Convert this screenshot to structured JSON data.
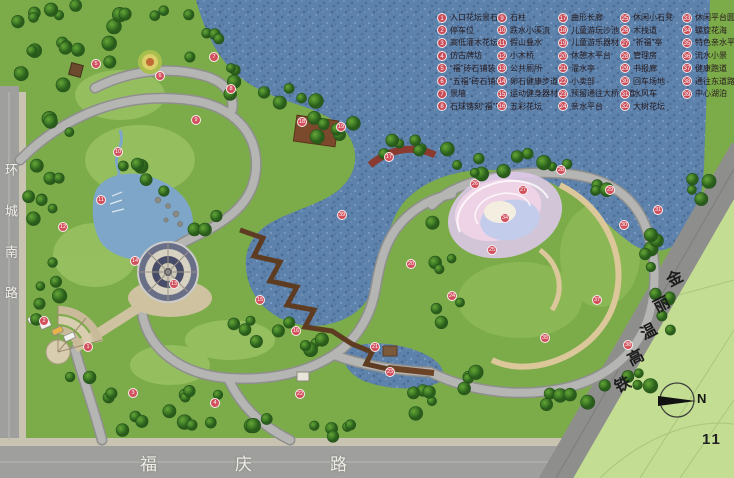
{
  "legend": {
    "columns": [
      {
        "items": [
          {
            "no": "1",
            "label": "入口花坛景石"
          },
          {
            "no": "2",
            "label": "停车位"
          },
          {
            "no": "3",
            "label": "高低灌木花坛"
          },
          {
            "no": "4",
            "label": "仿古牌坊"
          },
          {
            "no": "5",
            "label": "“福”砖石铺装"
          },
          {
            "no": "6",
            "label": "“五福”砖石铺装"
          },
          {
            "no": "7",
            "label": "景墙"
          },
          {
            "no": "8",
            "label": "石球镌刻“福”字"
          }
        ]
      },
      {
        "items": [
          {
            "no": "9",
            "label": "石柱"
          },
          {
            "no": "10",
            "label": "跌水小溪流"
          },
          {
            "no": "11",
            "label": "假山叠水"
          },
          {
            "no": "12",
            "label": "小木桥"
          },
          {
            "no": "13",
            "label": "公共厕所"
          },
          {
            "no": "14",
            "label": "卵石健康步道"
          },
          {
            "no": "15",
            "label": "运动健身器材"
          },
          {
            "no": "16",
            "label": "五彩花坛"
          }
        ]
      },
      {
        "items": [
          {
            "no": "17",
            "label": "曲形长廊"
          },
          {
            "no": "18",
            "label": "儿童游玩沙池"
          },
          {
            "no": "19",
            "label": "儿童游乐器材"
          },
          {
            "no": "20",
            "label": "休憩木平台"
          },
          {
            "no": "21",
            "label": "濯水亭"
          },
          {
            "no": "22",
            "label": "小卖部"
          },
          {
            "no": "23",
            "label": "预留通往大桥通道"
          },
          {
            "no": "24",
            "label": "亲水平台"
          }
        ]
      },
      {
        "items": [
          {
            "no": "25",
            "label": "休闲小石凳"
          },
          {
            "no": "26",
            "label": "木栈道"
          },
          {
            "no": "27",
            "label": "“祈福”亭"
          },
          {
            "no": "28",
            "label": "管理房"
          },
          {
            "no": "29",
            "label": "书报廊"
          },
          {
            "no": "30",
            "label": "回车场地"
          },
          {
            "no": "31",
            "label": "水风车"
          },
          {
            "no": "32",
            "label": "大树花坛"
          }
        ]
      },
      {
        "items": [
          {
            "no": "33",
            "label": "休闲平台圆凳"
          },
          {
            "no": "34",
            "label": "螺旋花海"
          },
          {
            "no": "35",
            "label": "特色亲水平台"
          },
          {
            "no": "36",
            "label": "流水小景"
          },
          {
            "no": "37",
            "label": "健康跑道"
          },
          {
            "no": "38",
            "label": "通往东道路"
          },
          {
            "no": "39",
            "label": "中心湖泊"
          }
        ]
      }
    ]
  },
  "roads": {
    "left_vertical": "环城南路",
    "bottom": "福庆路",
    "railway": "金丽温高铁"
  },
  "compass": {
    "label": "N"
  },
  "page_number": "11",
  "map_markers": [
    {
      "no": "5",
      "x": 96,
      "y": 64
    },
    {
      "no": "6",
      "x": 160,
      "y": 76
    },
    {
      "no": "7",
      "x": 214,
      "y": 57
    },
    {
      "no": "8",
      "x": 231,
      "y": 89
    },
    {
      "no": "9",
      "x": 196,
      "y": 120
    },
    {
      "no": "10",
      "x": 118,
      "y": 152
    },
    {
      "no": "11",
      "x": 101,
      "y": 200
    },
    {
      "no": "12",
      "x": 63,
      "y": 227
    },
    {
      "no": "14",
      "x": 135,
      "y": 261
    },
    {
      "no": "13",
      "x": 174,
      "y": 284
    },
    {
      "no": "2",
      "x": 44,
      "y": 321
    },
    {
      "no": "1",
      "x": 88,
      "y": 347
    },
    {
      "no": "3",
      "x": 133,
      "y": 393
    },
    {
      "no": "4",
      "x": 215,
      "y": 403
    },
    {
      "no": "15",
      "x": 260,
      "y": 300
    },
    {
      "no": "16",
      "x": 296,
      "y": 331
    },
    {
      "no": "18",
      "x": 302,
      "y": 122
    },
    {
      "no": "19",
      "x": 341,
      "y": 127
    },
    {
      "no": "17",
      "x": 389,
      "y": 157
    },
    {
      "no": "39",
      "x": 342,
      "y": 215
    },
    {
      "no": "20",
      "x": 411,
      "y": 264
    },
    {
      "no": "21",
      "x": 375,
      "y": 347
    },
    {
      "no": "22",
      "x": 300,
      "y": 394
    },
    {
      "no": "23",
      "x": 390,
      "y": 372
    },
    {
      "no": "24",
      "x": 452,
      "y": 296
    },
    {
      "no": "25",
      "x": 492,
      "y": 250
    },
    {
      "no": "26",
      "x": 475,
      "y": 184
    },
    {
      "no": "27",
      "x": 523,
      "y": 190
    },
    {
      "no": "28",
      "x": 561,
      "y": 170
    },
    {
      "no": "29",
      "x": 610,
      "y": 190
    },
    {
      "no": "30",
      "x": 624,
      "y": 225
    },
    {
      "no": "31",
      "x": 658,
      "y": 210
    },
    {
      "no": "34",
      "x": 505,
      "y": 218
    },
    {
      "no": "37",
      "x": 597,
      "y": 300
    },
    {
      "no": "35",
      "x": 545,
      "y": 338
    },
    {
      "no": "38",
      "x": 628,
      "y": 345
    }
  ],
  "colors": {
    "lake": "#5d82ac",
    "park_green": "#7cab4a",
    "field_green": "#c3dd92",
    "road_gray": "#9f9f9d",
    "railway_gray": "#8e8e8c",
    "marker_red": "#c94b58",
    "boardwalk_brown": "#5e3c22"
  }
}
